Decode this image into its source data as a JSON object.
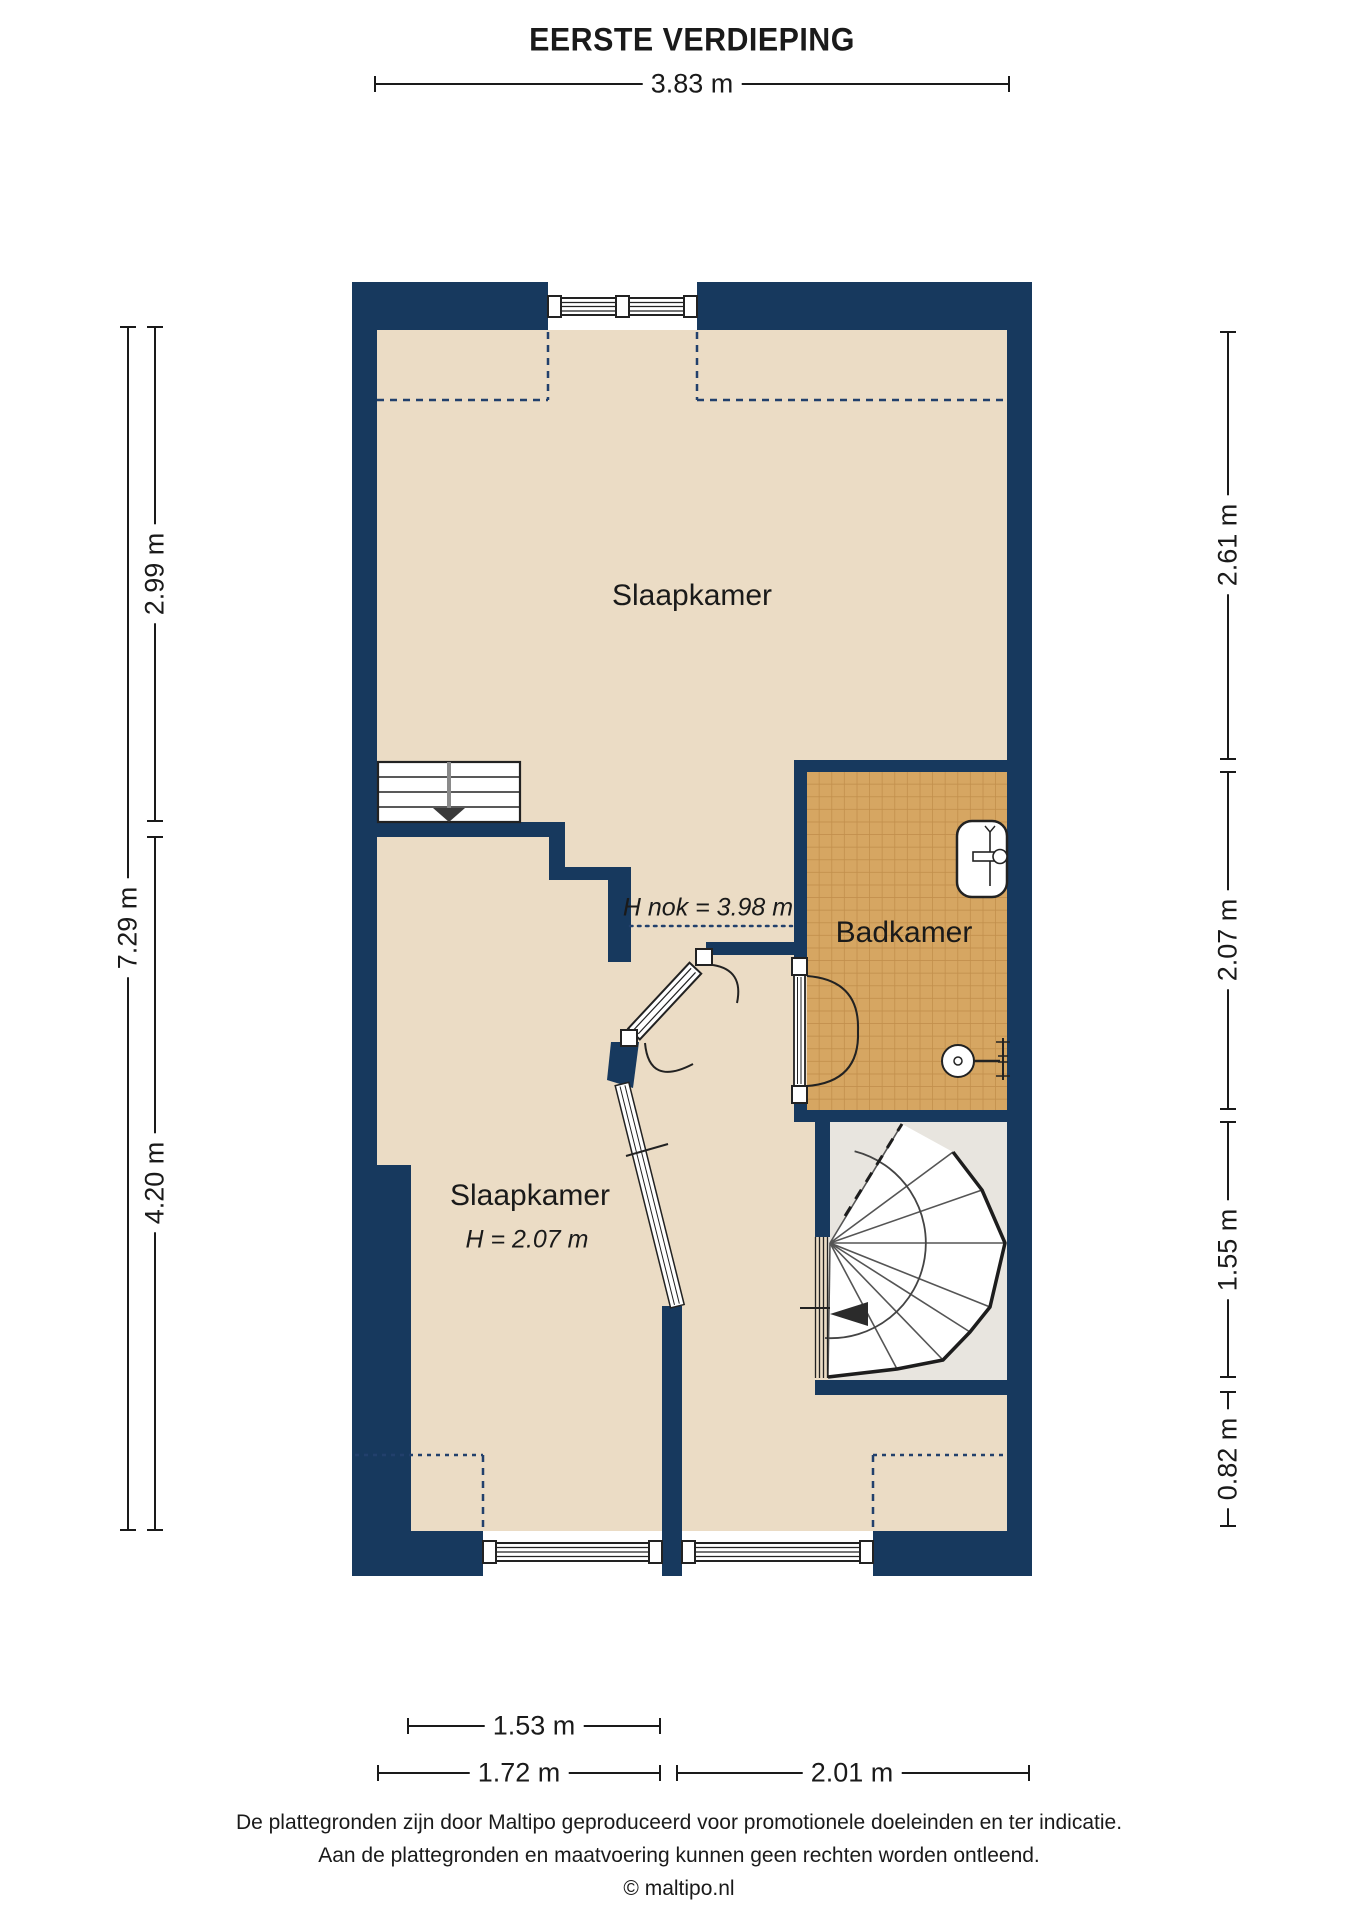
{
  "title": "EERSTE VERDIEPING",
  "colors": {
    "wall": "#17395E",
    "floor": "#EBDCC5",
    "tile": "#D6A662",
    "tile_line": "#C28F4C",
    "stair_floor": "#E8E5DF",
    "line": "#1A1A1A",
    "dash": "#22406C"
  },
  "rooms": {
    "bedroom_top": {
      "label": "Slaapkamer"
    },
    "bedroom_bottom": {
      "label": "Slaapkamer",
      "height_note": "H = 2.07 m"
    },
    "bathroom": {
      "label": "Badkamer"
    },
    "ridge_height_note": "H nok = 3.98 m"
  },
  "dimensions": {
    "top": {
      "width": {
        "label": "3.83 m"
      }
    },
    "left": {
      "total": {
        "label": "7.29 m"
      },
      "upper": {
        "label": "2.99 m"
      },
      "lower": {
        "label": "4.20 m"
      }
    },
    "right": {
      "seg1": {
        "label": "2.61 m"
      },
      "seg2": {
        "label": "2.07 m"
      },
      "seg3": {
        "label": "1.55 m"
      },
      "seg4": {
        "label": "0.82 m"
      }
    },
    "bottom": {
      "inner": {
        "label": "1.53 m"
      },
      "left": {
        "label": "1.72 m"
      },
      "right": {
        "label": "2.01 m"
      }
    }
  },
  "footer": {
    "line1": "De plattegronden zijn door Maltipo geproduceerd voor promotionele doeleinden en ter indicatie.",
    "line2": "Aan de plattegronden en maatvoering kunnen geen rechten worden ontleend.",
    "line3": "© maltipo.nl"
  }
}
